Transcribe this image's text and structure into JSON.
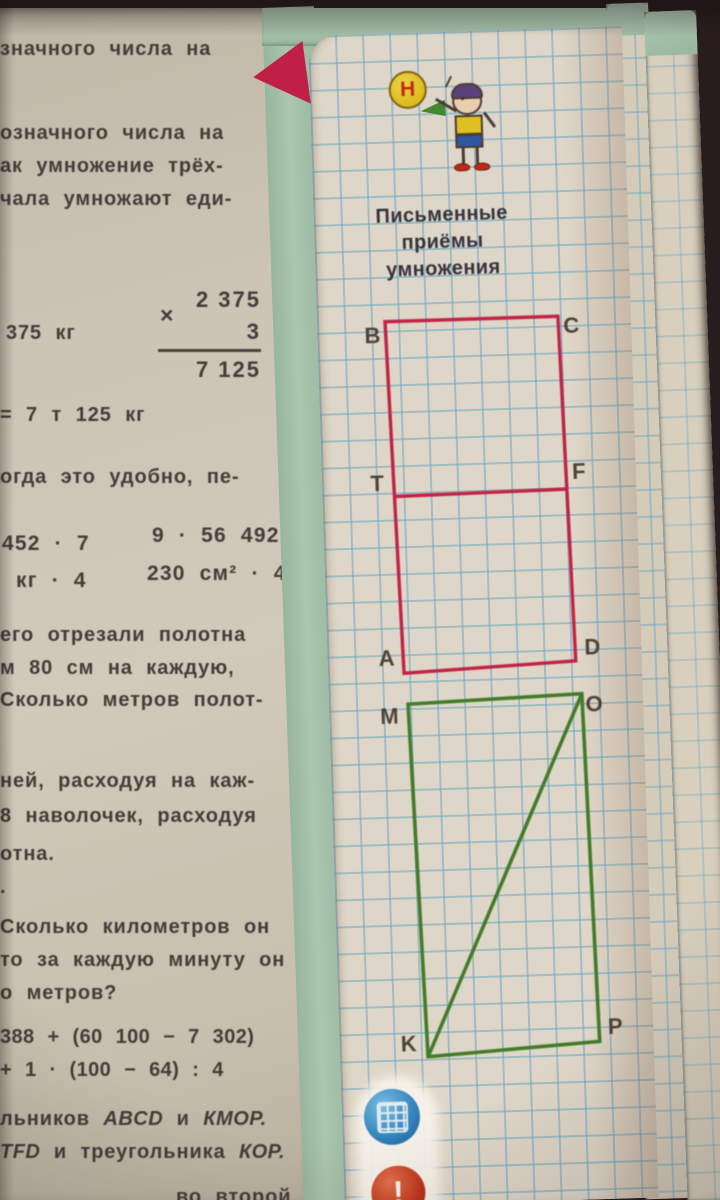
{
  "colors": {
    "cover_teal": "#a6c4ae",
    "grid_blue": "#62a8c8",
    "figure_red": "#c42045",
    "figure_green": "#3f7d28",
    "paper": "#e4ddcf",
    "background_dark": "#241a1c"
  },
  "left_page": {
    "lines": [
      "значного числа на",
      "означного числа на",
      "ак умножение трёх-",
      "чала умножают еди-",
      "375 кг",
      "= 7 т 125 кг",
      "огда это удобно, пе-",
      "452 · 7",
      "9 · 56 492",
      "кг · 4",
      "230 см² · 4",
      "его отрезали полотна",
      "м 80 см на каждую,",
      "Сколько метров полот-",
      "ней, расходуя на каж-",
      "8 наволочек, расходуя",
      "отна.",
      ".",
      "Сколько километров он",
      "то за каждую минуту он",
      "о метров?",
      "388 + (60 100 − 7 302)",
      "+ 1 · (100 − 64) : 4",
      "во второй —"
    ],
    "multiplication": {
      "sign": "×",
      "multiplicand": "2 375",
      "multiplier": "3",
      "product": "7 125"
    },
    "task_refs_1": {
      "pre": "льников ",
      "a": "ABCD",
      "mid": " и ",
      "b": "КМОР."
    },
    "task_refs_2": {
      "a": "TFD",
      "mid": " и треугольника ",
      "b": "КОР."
    }
  },
  "notebook": {
    "badge_letter": "Н",
    "title_lines": [
      "Письменные",
      "приёмы",
      "умножения"
    ],
    "red_rectangle": {
      "labels": {
        "B": "B",
        "C": "C",
        "T": "T",
        "F": "F",
        "A": "A",
        "D": "D"
      }
    },
    "green_rectangle": {
      "labels": {
        "M": "M",
        "O": "O",
        "K": "K",
        "P": "P"
      }
    },
    "icons": {
      "alert_label": "!"
    }
  }
}
